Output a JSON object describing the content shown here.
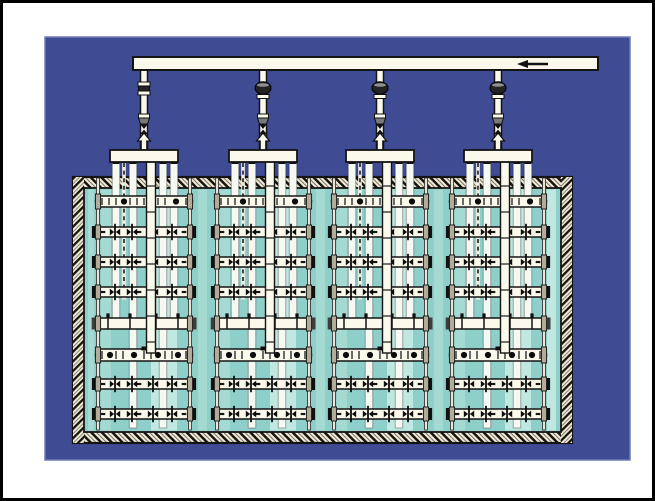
{
  "diagram": {
    "type": "technical-illustration",
    "subject": "Aeration tank with four drop-pipe diffuser grid assemblies fed by a common air supply header",
    "canvas": {
      "width": 655,
      "height": 501,
      "frame_stroke": 3
    },
    "colors": {
      "frame": "#000000",
      "margin": "#ffffff",
      "panel": "#3f4b93",
      "panel_edge": "#707bb6",
      "pipe_fill": "#fbf8ec",
      "pipe_bright": "#f6f8f2",
      "pipe_stroke": "#141414",
      "water": "#8fcfca",
      "water_band": "#a5dad3",
      "water_band_bright": "#c0e7e0",
      "wall_fill": "#f1ead8",
      "wall_mark": "#17140e",
      "metal_dark": "#232323",
      "metal_mid": "#7a7a7a",
      "clamp_fill": "#b3ab99",
      "fitting": "#0c0c0c"
    },
    "panel": {
      "x": 45,
      "y": 37,
      "w": 585,
      "h": 423
    },
    "header_pipe": {
      "x1": 133,
      "x2": 598,
      "y": 57,
      "h": 13,
      "arrow": {
        "tip_x": 517,
        "tail_x": 548,
        "y": 64,
        "direction": "left"
      }
    },
    "tank": {
      "x": 73,
      "y": 177,
      "w": 499,
      "h": 266,
      "wall": 11
    },
    "water_bands": [
      {
        "x": 88,
        "w": 6,
        "bright": false
      },
      {
        "x": 198,
        "w": 9,
        "bright": false
      },
      {
        "x": 316,
        "w": 9,
        "bright": false
      },
      {
        "x": 434,
        "w": 9,
        "bright": false
      },
      {
        "x": 547,
        "w": 9,
        "bright": true
      }
    ],
    "assembly": {
      "count": 4,
      "centers": [
        144,
        263,
        380,
        498
      ],
      "half_width": 48.5,
      "riser": {
        "width": 7,
        "top": 70,
        "bottom": 151
      },
      "valve_types": [
        "union",
        "ball",
        "ball",
        "ball"
      ],
      "valve_y": 88,
      "reducer_y": 114,
      "nozzle_y": 124,
      "arrow_tip_y": 133,
      "manifold": {
        "half_width": 34,
        "y": 150,
        "height": 12
      },
      "drop_pipes": [
        {
          "dx": -28,
          "depth": 326
        },
        {
          "dx": -11,
          "depth": 428
        },
        {
          "dx": 19,
          "depth": 428
        },
        {
          "dx": 30,
          "depth": 326
        }
      ],
      "downcomer": {
        "dx": 7,
        "width": 9,
        "bottom": 353
      },
      "rod": {
        "dx": -20,
        "top": 163,
        "bottom": 300
      },
      "rails": {
        "dx": 46,
        "top": 178,
        "bottom": 430,
        "width": 3
      },
      "bands": [
        {
          "dx": -38,
          "w": 10,
          "bright": false
        },
        {
          "dx": 20,
          "w": 26,
          "bright": true
        }
      ]
    },
    "row_types": {
      "header": {
        "height": 11,
        "cap": "round",
        "circles": [
          -20,
          8,
          32
        ],
        "tick_step": 7
      },
      "lateral": {
        "height": 10,
        "cap": "square",
        "bowties": [
          -29,
          -12,
          9,
          28
        ],
        "dash_step": 9
      },
      "plain": {
        "height": 11,
        "cap": "dark",
        "clamps": [
          -36,
          -14,
          12,
          34
        ]
      },
      "header2": {
        "height": 12,
        "cap": "round",
        "circles": [
          -34,
          -10,
          14,
          34
        ],
        "tick_step": 7,
        "notch": true
      }
    },
    "rows": [
      {
        "y": 196,
        "type": "header"
      },
      {
        "y": 227,
        "type": "lateral"
      },
      {
        "y": 257,
        "type": "lateral"
      },
      {
        "y": 287,
        "type": "lateral"
      },
      {
        "y": 318,
        "type": "plain"
      },
      {
        "y": 349,
        "type": "header2"
      },
      {
        "y": 379,
        "type": "lateral"
      },
      {
        "y": 409,
        "type": "lateral"
      }
    ],
    "icons": {
      "flow_direction": "left-arrow",
      "riser_flow": "up-arrow"
    }
  }
}
